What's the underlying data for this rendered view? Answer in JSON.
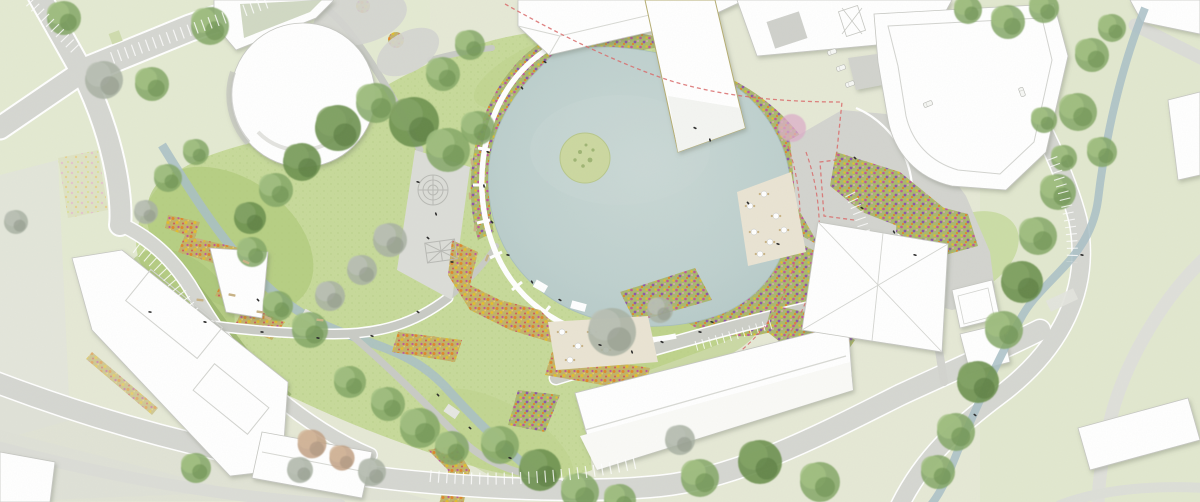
{
  "meta": {
    "kind": "landscape-masterplan-site-plan",
    "description": "Aerial watercolor-style site plan of a park with central pond, flower bands, buildings, roads and streams",
    "canvas": {
      "width": 1200,
      "height": 502
    },
    "visible_text": "none"
  },
  "colors": {
    "base": "#e6e9d6",
    "lawn_pale": "#e3e9d0",
    "lawn_grey": "#e3e5dc",
    "park_green": "#c7da9a",
    "slope_green": "#b2cb7c",
    "bright_green": "#c9dba1",
    "hedge_green": "#9ab46c",
    "tree_green": "#84a766",
    "tree_dark": "#6d9150",
    "tree_grey": "#a9b1a3",
    "tree_autumn": "#c2a184",
    "tree_blossom": "#dcaec8",
    "pond": "#bed0ce",
    "pond_light": "#cbd9d6",
    "island": "#ccd8a0",
    "stream": "#a9c0c7",
    "road": "#d6d7d2",
    "road_light": "#dfe0da",
    "path": "#c9cbc5",
    "plaza": "#d3d4cf",
    "playground": "#dcddd8",
    "building": "#ffffff",
    "building_line": "#c6c7c2",
    "roof_line": "#d8d9d4",
    "courtyard_grey": "#d0d1cc",
    "terrace": "#eae4d3",
    "bench": "#c8b285",
    "flower_base_mix": "#a9b86f",
    "flower_base_warm": "#c2b269",
    "flower_magenta": "#c0559a",
    "flower_purple": "#8e56a8",
    "flower_orange": "#e0862a",
    "flower_yellow": "#e2bd2e",
    "flower_pink": "#e3a4c6",
    "boundary_red": "#d96b6b",
    "khaki_outline": "#b5ad72",
    "people": "#2a2a2a",
    "white_edge": "#ffffff"
  },
  "features": [
    {
      "name": "central-pond",
      "kind": "water"
    },
    {
      "name": "pond-island-with-tree",
      "kind": "water-island"
    },
    {
      "name": "west-stream",
      "kind": "water"
    },
    {
      "name": "east-stream",
      "kind": "water"
    },
    {
      "name": "park-lawn",
      "kind": "greenspace"
    },
    {
      "name": "flower-band-northwest-rim",
      "kind": "planting"
    },
    {
      "name": "flower-mass-east-of-pond",
      "kind": "planting"
    },
    {
      "name": "flower-steps-southwest-rim",
      "kind": "planting"
    },
    {
      "name": "flower-zigzag-west-slope",
      "kind": "planting"
    },
    {
      "name": "playground-plaza-with-labyrinth",
      "kind": "plaza"
    },
    {
      "name": "cafe-terrace-with-tables",
      "kind": "plaza"
    },
    {
      "name": "hall-north-terrace",
      "kind": "plaza"
    },
    {
      "name": "white-promenade-pond-edge",
      "kind": "path"
    },
    {
      "name": "round-pavilion-building",
      "kind": "building"
    },
    {
      "name": "north-hip-roof-slab",
      "kind": "building"
    },
    {
      "name": "pier-building-into-pond",
      "kind": "building"
    },
    {
      "name": "northeast-complex-with-courtyards",
      "kind": "building"
    },
    {
      "name": "east-curved-building",
      "kind": "building"
    },
    {
      "name": "west-residential-complex",
      "kind": "building"
    },
    {
      "name": "south-event-hall",
      "kind": "building"
    },
    {
      "name": "faceted-roof-pavilion",
      "kind": "building"
    },
    {
      "name": "glass-pavilion-squares",
      "kind": "building"
    },
    {
      "name": "south-house",
      "kind": "building"
    },
    {
      "name": "southeast-house",
      "kind": "building"
    },
    {
      "name": "road-network-with-parking",
      "kind": "road"
    },
    {
      "name": "red-dashed-boundary-lines",
      "kind": "annotation"
    },
    {
      "name": "trees",
      "kind": "vegetation"
    },
    {
      "name": "people-figures",
      "kind": "staffage"
    },
    {
      "name": "benches",
      "kind": "furniture"
    }
  ]
}
